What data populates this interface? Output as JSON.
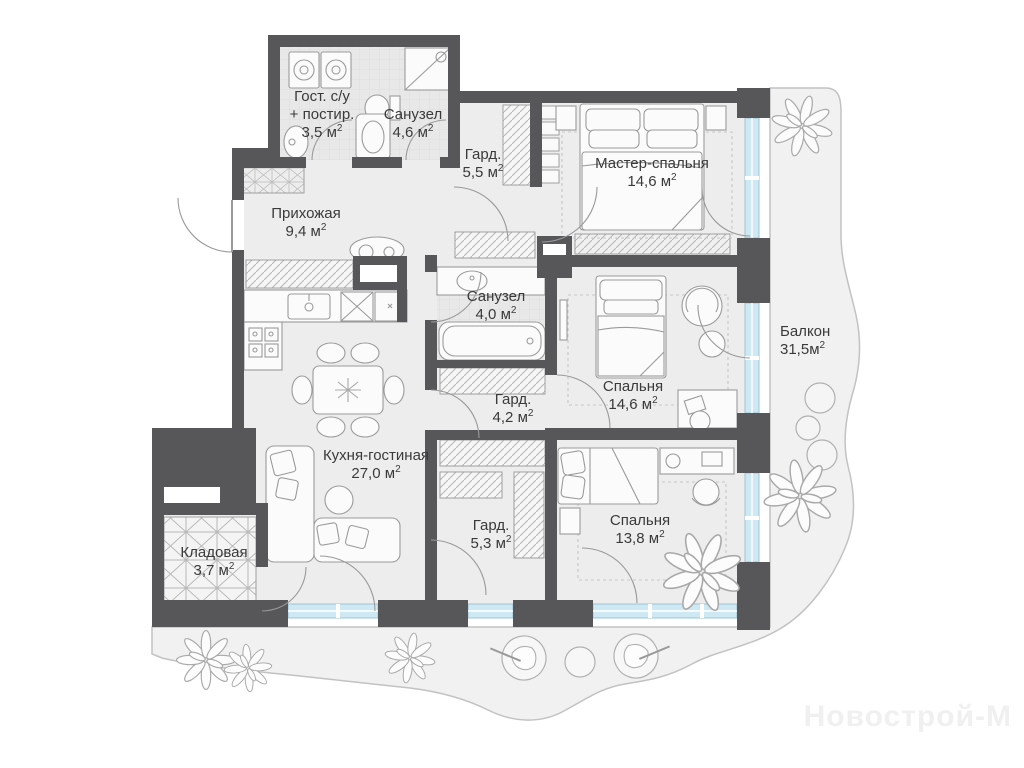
{
  "watermark": "Новострой-М",
  "sup": "2",
  "rooms": [
    {
      "name": "Гост. с/у",
      "name2": "+ постир.",
      "area": "3,5 м"
    },
    {
      "name": "Санузел",
      "area": "4,6 м"
    },
    {
      "name": "Гард.",
      "area": "5,5 м"
    },
    {
      "name": "Мастер-спальня",
      "area": "14,6 м"
    },
    {
      "name": "Прихожая",
      "area": "9,4 м"
    },
    {
      "name": "Санузел",
      "area": "4,0 м"
    },
    {
      "name": "Спальня",
      "area": "14,6 м"
    },
    {
      "name": "Балкон",
      "area": "31,5м"
    },
    {
      "name": "Гард.",
      "area": "4,2 м"
    },
    {
      "name": "Кухня-гостиная",
      "area": "27,0 м"
    },
    {
      "name": "Гард.",
      "area": "5,3 м"
    },
    {
      "name": "Спальня",
      "area": "13,8 м"
    },
    {
      "name": "Кладовая",
      "area": "3,7 м"
    }
  ]
}
